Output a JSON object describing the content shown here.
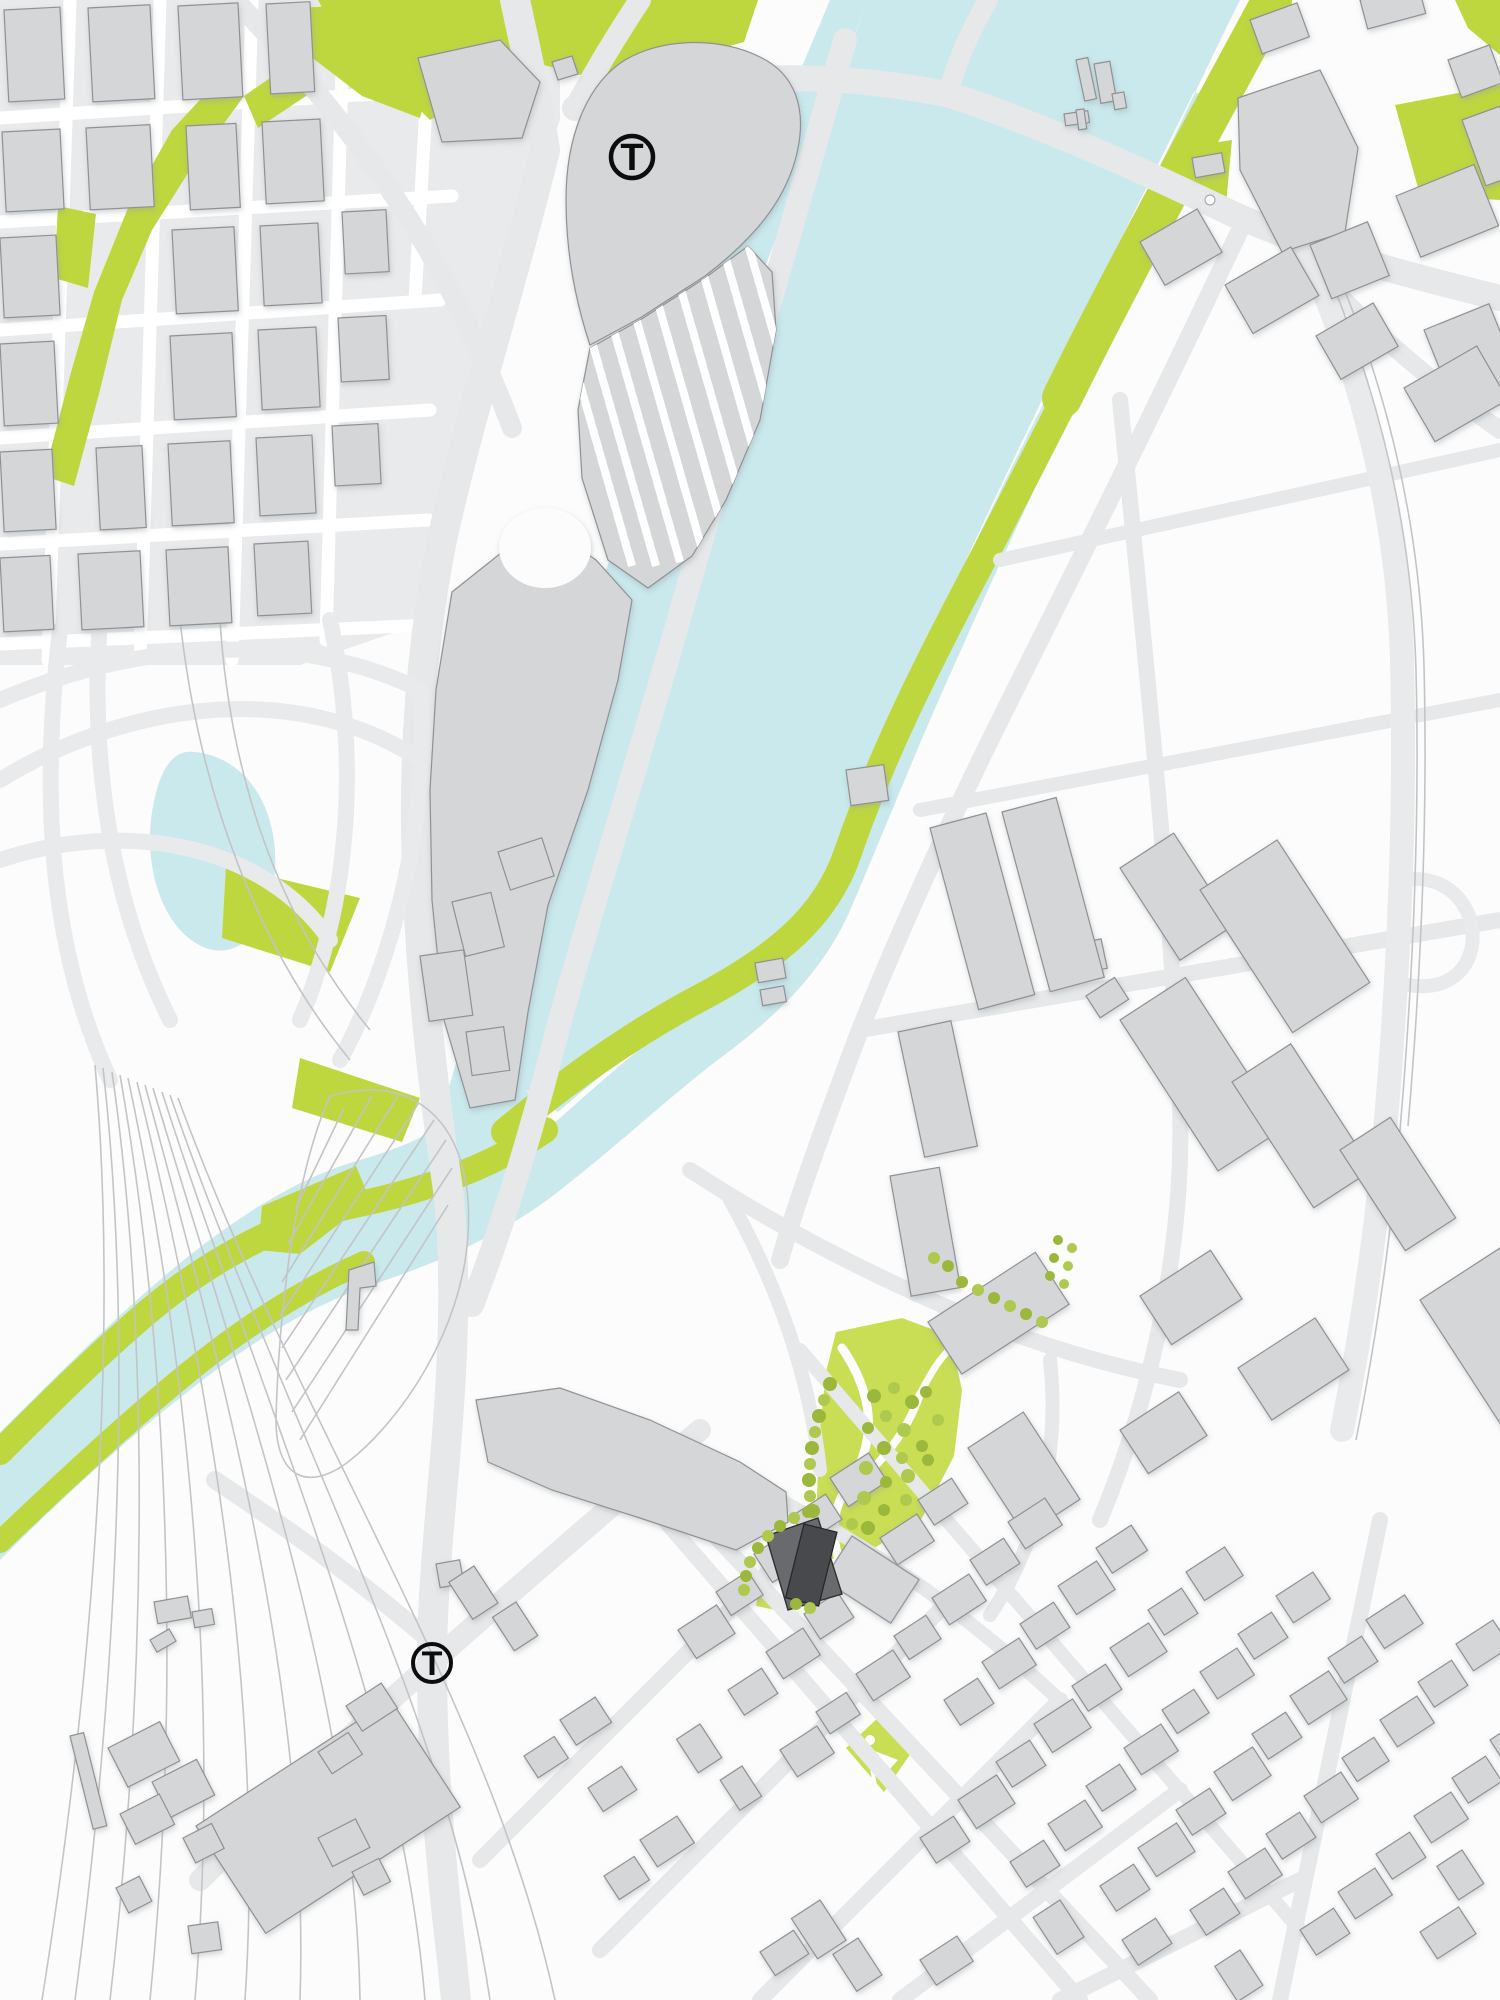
{
  "map": {
    "kind": "architectural site plan",
    "width_px": 1500,
    "height_px": 2000,
    "markers": {
      "transit": [
        {
          "id": "transit-station-north",
          "label": "T",
          "x": 632,
          "y": 157
        },
        {
          "id": "transit-station-south",
          "label": "T",
          "x": 432,
          "y": 1663
        }
      ]
    },
    "features": {
      "river": "wide water channel running diagonally from top edge to center, narrowing to a stream exiting the left edge",
      "pond": "small pond inside highway interchange loops at left middle",
      "riverbank_green": "green landscaped strip along east bank of river and stream",
      "station": "rail station building with hatched platform tracks, top center",
      "park_with_trees": "lawn park with curved white paths and tree dots, center lower right",
      "pocket_park": "small green square park with white path marks near bottom center",
      "highlighted_site": "dark two-tone building parcel with tree row, below the park",
      "rail_yard": "fanning thin track lines and loop, bottom left",
      "house_grid": "dense diagonal grid of small residential blocks, bottom"
    }
  },
  "palette": {
    "land": "#fcfcfc",
    "zonebg": "#e9eaeb",
    "street": "#ffffff",
    "road": "#e6e8e9",
    "ramp": "#e9eaeb",
    "rail": "#c3c4c6",
    "water": "#c9e9ed",
    "green": "#bed73f",
    "lawn": "#c9dd55",
    "tree": "#9cb83c",
    "tree2": "#aec94e",
    "building": "#d4d6d8",
    "bstroke": "#8f9194",
    "site1": "#696a6d",
    "site2": "#48494c",
    "marker": "#0d0d0d"
  }
}
